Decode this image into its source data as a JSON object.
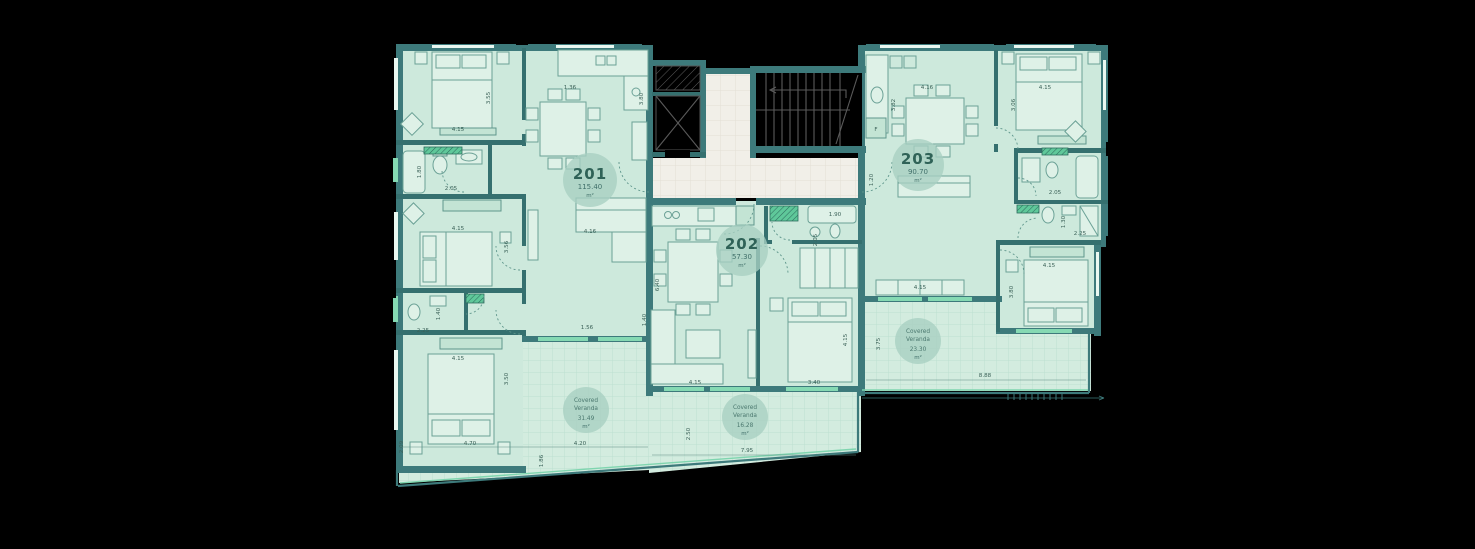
{
  "apartments": [
    {
      "number": "201",
      "area": "115.40",
      "unit": "m²"
    },
    {
      "number": "202",
      "area": "57.30",
      "unit": "m²"
    },
    {
      "number": "203",
      "area": "90.70",
      "unit": "m²"
    }
  ],
  "verandas": [
    {
      "label_line1": "Covered",
      "label_line2": "Veranda",
      "area": "31.49",
      "unit": "m²"
    },
    {
      "label_line1": "Covered",
      "label_line2": "Veranda",
      "area": "16.28",
      "unit": "m²"
    },
    {
      "label_line1": "Covered",
      "label_line2": "Veranda",
      "area": "23.30",
      "unit": "m²"
    }
  ],
  "appliance_labels": {
    "fridge": "F"
  },
  "dimensions": [
    {
      "v": "4.15"
    },
    {
      "v": "3.55"
    },
    {
      "v": "1.36"
    },
    {
      "v": "3.80"
    },
    {
      "v": "1.80"
    },
    {
      "v": "2.05"
    },
    {
      "v": "4.15"
    },
    {
      "v": "3.56"
    },
    {
      "v": "4.16"
    },
    {
      "v": "2.25"
    },
    {
      "v": "1.40"
    },
    {
      "v": "4.15"
    },
    {
      "v": "3.50"
    },
    {
      "v": "1.56"
    },
    {
      "v": "1.40"
    },
    {
      "v": "2.09"
    },
    {
      "v": "4.70"
    },
    {
      "v": "1.86"
    },
    {
      "v": "4.20"
    },
    {
      "v": "6.40"
    },
    {
      "v": "4.15"
    },
    {
      "v": "3.40"
    },
    {
      "v": "4.15"
    },
    {
      "v": "1.90"
    },
    {
      "v": "2.05"
    },
    {
      "v": "2.50"
    },
    {
      "v": "7.95"
    },
    {
      "v": "4.16"
    },
    {
      "v": "3.82"
    },
    {
      "v": "4.15"
    },
    {
      "v": "3.06"
    },
    {
      "v": "1.20"
    },
    {
      "v": "2.05"
    },
    {
      "v": "2.25"
    },
    {
      "v": "1.30"
    },
    {
      "v": "4.15"
    },
    {
      "v": "3.80"
    },
    {
      "v": "4.15"
    },
    {
      "v": "3.75"
    },
    {
      "v": "8.88"
    }
  ],
  "colors": {
    "background": "#000000",
    "wall": "#3d7a7b",
    "room_fill": "#cde9dc",
    "veranda_fill": "#d3ecdf",
    "corridor_fill": "#f1efe8",
    "accent_green": "#5fc89a",
    "window_green": "#85d9b3",
    "badge_fill": "#a8d0c1",
    "text_dark_teal": "#2f6257"
  }
}
